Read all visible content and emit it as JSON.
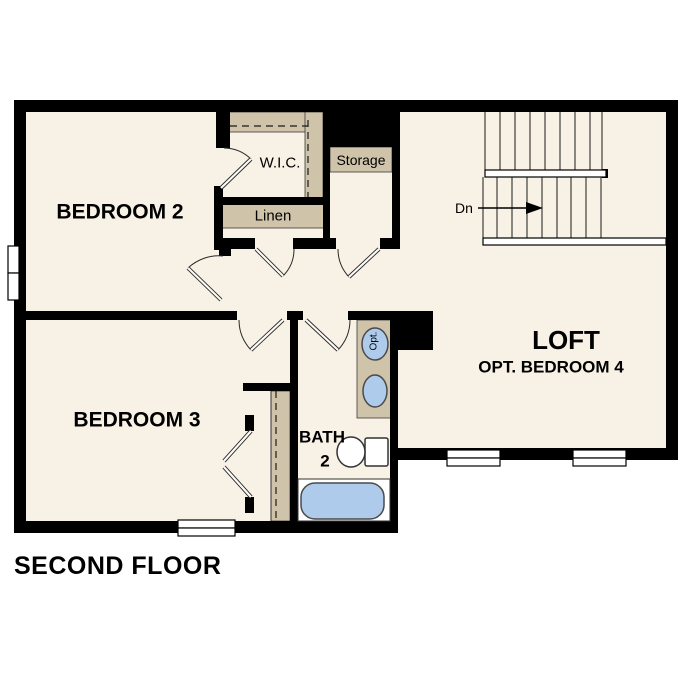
{
  "title": "SECOND FLOOR",
  "floor_label": "SECOND FLOOR",
  "theme": {
    "background": "#ffffff",
    "wall_color": "#000000",
    "floor_color": "#f8f1e5",
    "shelf_color": "#cfc3aa",
    "fixture_blue": "#aecbec",
    "text_color": "#000000"
  },
  "rooms": {
    "bedroom2": {
      "label": "BEDROOM 2"
    },
    "bedroom3": {
      "label": "BEDROOM 3"
    },
    "wic": {
      "label": "W.I.C."
    },
    "linen": {
      "label": "Linen"
    },
    "storage": {
      "label": "Storage"
    },
    "loft": {
      "label": "LOFT",
      "sublabel": "OPT. BEDROOM 4"
    },
    "bath": {
      "label": "BATH",
      "number": "2"
    },
    "stairs": {
      "direction_label": "Dn"
    },
    "vanity": {
      "optional_label": "Opt."
    }
  }
}
